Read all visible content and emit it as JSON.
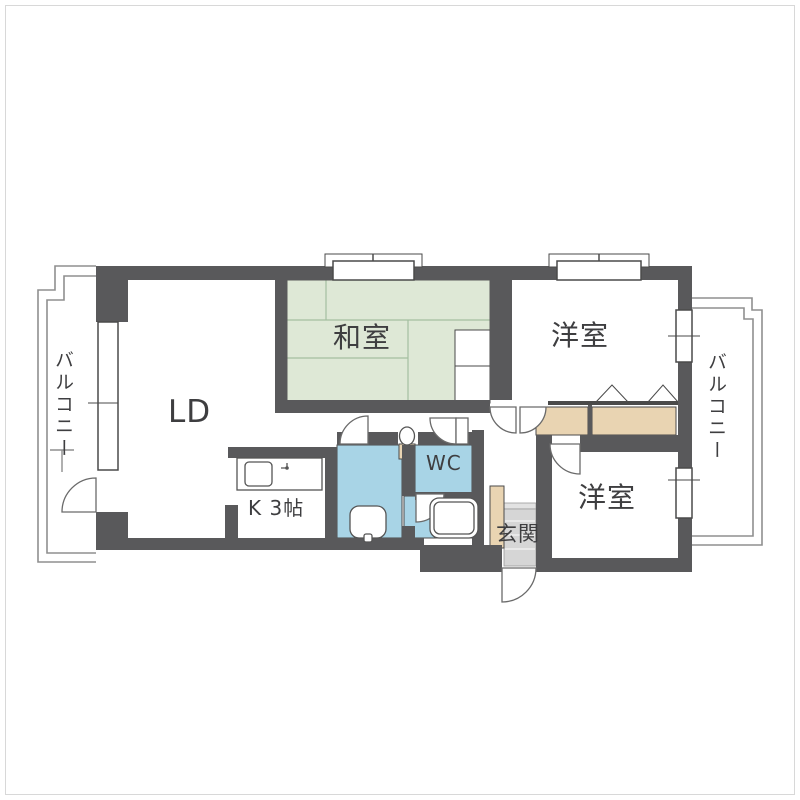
{
  "floorplan": {
    "type": "apartment-floor-plan",
    "colors": {
      "wall": "#59595b",
      "tatami": "#dee8d6",
      "tatami_line": "#a4bfa0",
      "wet_area": "#a8d4e6",
      "closet": "#e9d4b2",
      "entry_floor": "#d6d6d6",
      "outline": "#8f8f8f",
      "text": "#3e3e40"
    },
    "rooms": {
      "living_dining": {
        "label": "LD"
      },
      "japanese_room": {
        "label": "和室"
      },
      "western_room_top": {
        "label": "洋室"
      },
      "western_room_bottom": {
        "label": "洋室"
      },
      "kitchen": {
        "label": "K 3帖"
      },
      "toilet_room": {
        "label": "WC"
      },
      "entrance": {
        "label": "玄関"
      },
      "balcony_left": {
        "label": "バルコニー"
      },
      "balcony_right": {
        "label": "バルコニー"
      }
    },
    "fixtures": [
      "kitchen-sink",
      "washbasin",
      "toilet",
      "bathtub",
      "shoe-cabinet",
      "closets"
    ]
  }
}
